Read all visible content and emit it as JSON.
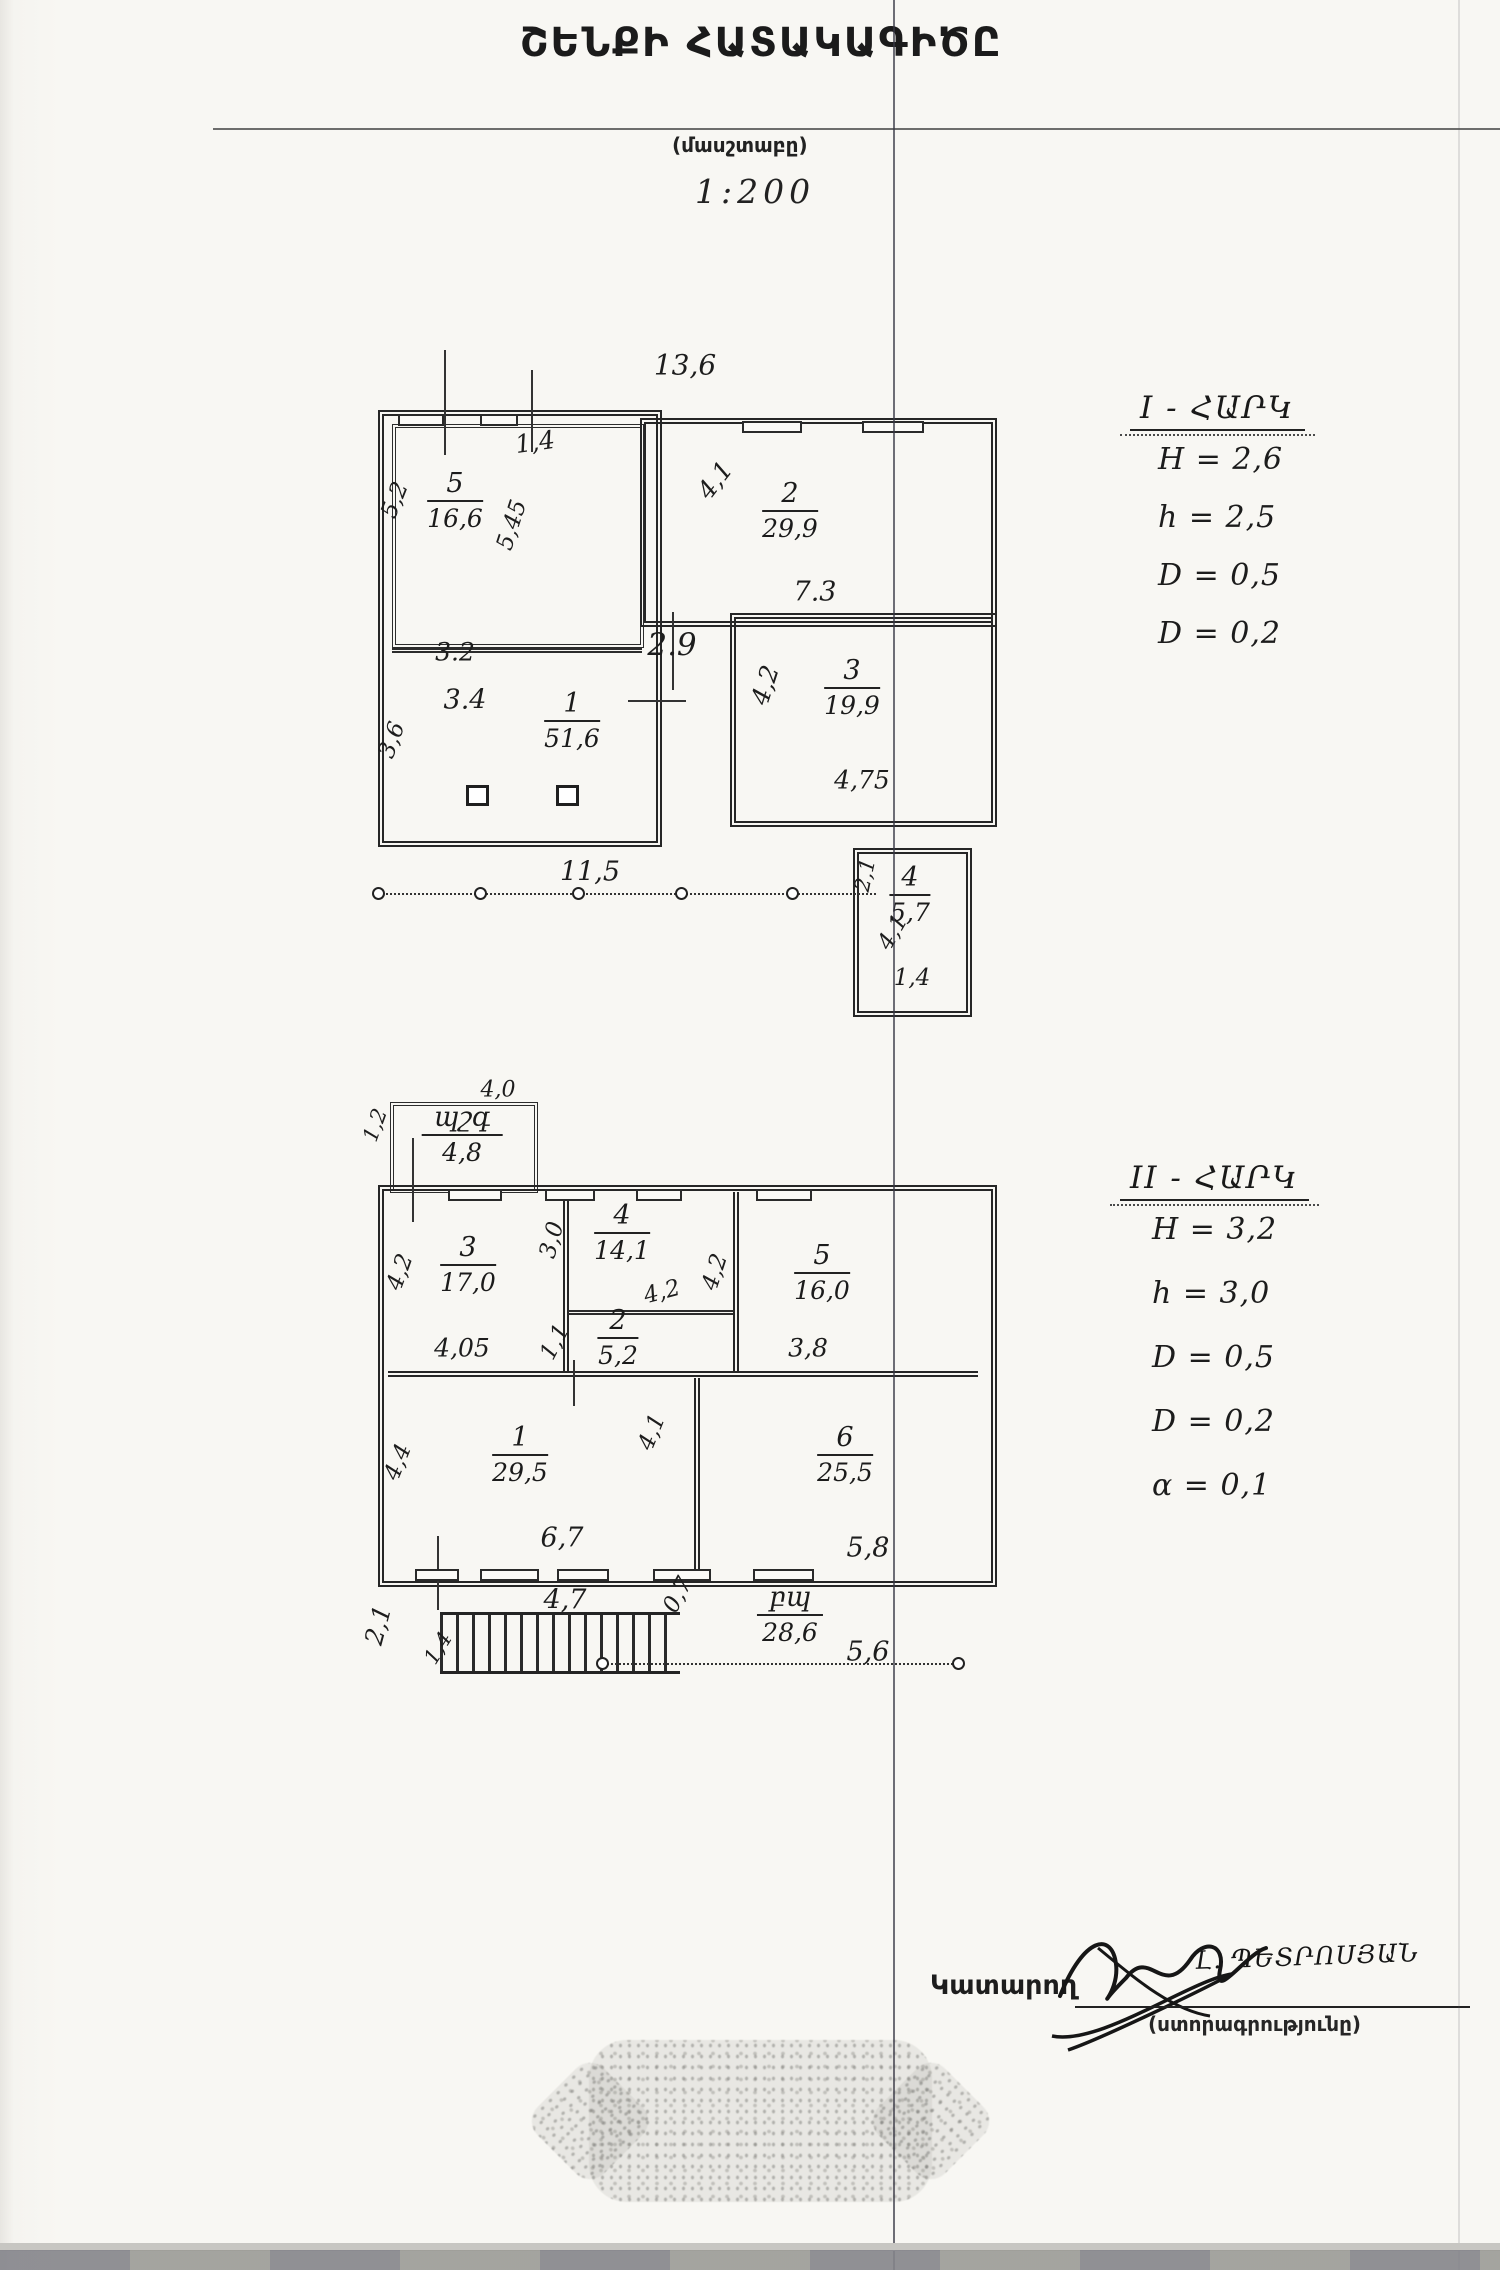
{
  "page": {
    "title": "ՇԵՆՔԻ ՀԱՏԱԿԱԳԻԾԸ",
    "scale_caption": "(մասշտաբը)",
    "scale_value": "1:200"
  },
  "floor1": {
    "heading": "I - ՀԱՐԿ",
    "params": [
      "H = 2,6",
      "h = 2,5",
      "D = 0,5",
      "D = 0,2"
    ],
    "rooms": [
      {
        "n": "5",
        "a": "16,6",
        "x": 455,
        "y": 468
      },
      {
        "n": "2",
        "a": "29,9",
        "x": 790,
        "y": 478
      },
      {
        "n": "1",
        "a": "51,6",
        "x": 572,
        "y": 688
      },
      {
        "n": "3",
        "a": "19,9",
        "x": 852,
        "y": 655
      },
      {
        "n": "4",
        "a": "5,7",
        "x": 910,
        "y": 862
      }
    ],
    "dims": [
      {
        "t": "13,6",
        "x": 685,
        "y": 365,
        "s": 28
      },
      {
        "t": "1,4",
        "x": 535,
        "y": 442,
        "s": 25,
        "r": -8
      },
      {
        "t": "5,45",
        "x": 512,
        "y": 525,
        "s": 23,
        "r": -72
      },
      {
        "t": "5,2",
        "x": 395,
        "y": 500,
        "s": 23,
        "r": -68
      },
      {
        "t": "3.2",
        "x": 455,
        "y": 652,
        "s": 25
      },
      {
        "t": "3.4",
        "x": 465,
        "y": 700,
        "s": 27
      },
      {
        "t": "3,6",
        "x": 392,
        "y": 740,
        "s": 23,
        "r": -70
      },
      {
        "t": "2.9",
        "x": 672,
        "y": 645,
        "s": 31
      },
      {
        "t": "4,1",
        "x": 715,
        "y": 480,
        "s": 25,
        "r": -52
      },
      {
        "t": "7.3",
        "x": 815,
        "y": 592,
        "s": 27
      },
      {
        "t": "4,2",
        "x": 765,
        "y": 685,
        "s": 25,
        "r": -72
      },
      {
        "t": "4,75",
        "x": 862,
        "y": 780,
        "s": 25
      },
      {
        "t": "11,5",
        "x": 590,
        "y": 872,
        "s": 27
      },
      {
        "t": "2,1",
        "x": 865,
        "y": 875,
        "s": 21,
        "r": -78
      },
      {
        "t": "4,1",
        "x": 893,
        "y": 932,
        "s": 23,
        "r": -60
      },
      {
        "t": "1,4",
        "x": 912,
        "y": 978,
        "s": 23
      }
    ]
  },
  "floor2": {
    "heading": "II - ՀԱՐԿ",
    "params": [
      "H = 3,2",
      "h = 3,0",
      "D = 0,5",
      "D = 0,2",
      "α = 0,1"
    ],
    "rooms": [
      {
        "n": "պշգ",
        "a": "4,8",
        "x": 462,
        "y": 1102
      },
      {
        "n": "3",
        "a": "17,0",
        "x": 468,
        "y": 1232
      },
      {
        "n": "4",
        "a": "14,1",
        "x": 622,
        "y": 1200
      },
      {
        "n": "5",
        "a": "16,0",
        "x": 822,
        "y": 1240
      },
      {
        "n": "2",
        "a": "5,2",
        "x": 618,
        "y": 1305
      },
      {
        "n": "1",
        "a": "29,5",
        "x": 520,
        "y": 1422
      },
      {
        "n": "6",
        "a": "25,5",
        "x": 845,
        "y": 1422
      },
      {
        "n": "բպ",
        "a": "28,6",
        "x": 790,
        "y": 1582
      }
    ],
    "dims": [
      {
        "t": "4,0",
        "x": 498,
        "y": 1090,
        "s": 22
      },
      {
        "t": "1,2",
        "x": 375,
        "y": 1125,
        "s": 21,
        "r": -70
      },
      {
        "t": "3,0",
        "x": 552,
        "y": 1240,
        "s": 23,
        "r": -75
      },
      {
        "t": "4,2",
        "x": 400,
        "y": 1272,
        "s": 23,
        "r": -70
      },
      {
        "t": "4,05",
        "x": 462,
        "y": 1348,
        "s": 25
      },
      {
        "t": "4,2",
        "x": 662,
        "y": 1292,
        "s": 23,
        "r": -15
      },
      {
        "t": "4,2",
        "x": 715,
        "y": 1272,
        "s": 23,
        "r": -72
      },
      {
        "t": "1,1",
        "x": 555,
        "y": 1342,
        "s": 23,
        "r": -62
      },
      {
        "t": "3,8",
        "x": 808,
        "y": 1348,
        "s": 25
      },
      {
        "t": "4,4",
        "x": 398,
        "y": 1462,
        "s": 23,
        "r": -68
      },
      {
        "t": "6,7",
        "x": 562,
        "y": 1538,
        "s": 27
      },
      {
        "t": "4,1",
        "x": 652,
        "y": 1432,
        "s": 23,
        "r": -68
      },
      {
        "t": "5,8",
        "x": 868,
        "y": 1548,
        "s": 27
      },
      {
        "t": "2,1",
        "x": 378,
        "y": 1625,
        "s": 25,
        "r": -75
      },
      {
        "t": "1,4",
        "x": 438,
        "y": 1648,
        "s": 21,
        "r": -58
      },
      {
        "t": "4,7",
        "x": 565,
        "y": 1600,
        "s": 27
      },
      {
        "t": "0,7",
        "x": 678,
        "y": 1595,
        "s": 23,
        "r": -62
      },
      {
        "t": "5,6",
        "x": 868,
        "y": 1652,
        "s": 27
      }
    ]
  },
  "signature": {
    "label": "Կատարող",
    "name": "Լ. ՊԵՏՐՈՍՅԱՆ",
    "caption": "(ստորագրությունը)"
  }
}
